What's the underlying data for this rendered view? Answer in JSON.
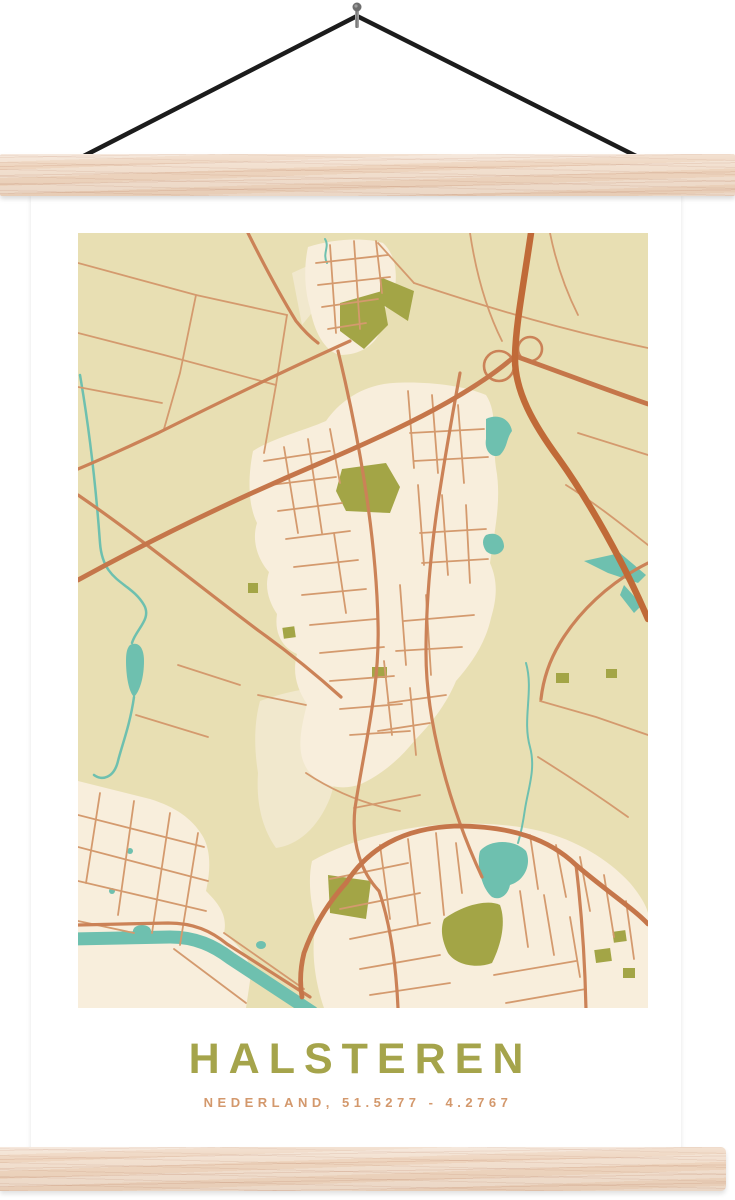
{
  "poster": {
    "title": "HALSTEREN",
    "subtitle": "NEDERLAND, 51.5277 - 4.2767"
  },
  "palette": {
    "title-green": "#a5a44b",
    "subtitle-orange": "#d3986c",
    "map-bg": "#e8dfb3",
    "map-urban": "#f8eedc",
    "map-urban-pale": "#f1e8cd",
    "map-green": "#a3a546",
    "map-water": "#6ec0af",
    "road-minor": "#d49a6e",
    "road-medium": "#cb8257",
    "road-major": "#c5764a",
    "road-motorway": "#c06a38",
    "wood": "#eed5bf",
    "cord": "#1c1c1c",
    "paper": "#ffffff"
  }
}
